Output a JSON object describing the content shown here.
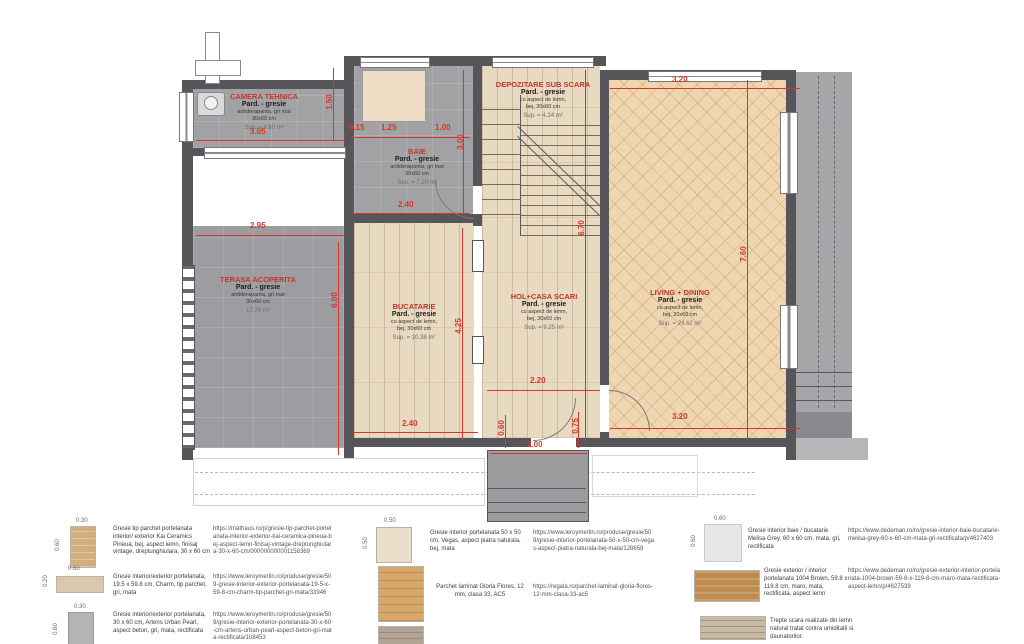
{
  "colors": {
    "dimension_red": "#d6372b",
    "room_title_red": "#c3352b",
    "wall_grey": "#56565a",
    "floor_grey": "#a2a2a5",
    "floor_wood": "#e8d9c1",
    "floor_herringbone": "#eed6b1"
  },
  "plan": {
    "rooms": [
      {
        "title": "CAMERA TEHNICA",
        "floor": "Pard. - gresie",
        "material": "antiderapanta, gri mat",
        "size": "30x60 cm",
        "area": "Sup. = 4.80 m²"
      },
      {
        "title": "BAIE",
        "floor": "Pard. - gresie",
        "material": "antiderapanta, gri mat",
        "size": "30x60 cm",
        "area": "Sup. = 7.20 m²"
      },
      {
        "title": "DEPOZITARE SUB SCARA",
        "floor": "Pard. - gresie",
        "material": "cu aspect de lemn,",
        "size": "bej, 30x60 cm",
        "area": "Sup. = 4.24 m²"
      },
      {
        "title": "TERASA ACOPERITA",
        "floor": "Pard. - gresie",
        "material": "antiderapanta, gri mat",
        "size": "30x60 cm",
        "area": "17.76 m²"
      },
      {
        "title": "BUCATARIE",
        "floor": "Pard. - gresie",
        "material": "cu aspect de lemn,",
        "size": "bej, 30x60 cm",
        "area": "Sup. = 10.38 m²"
      },
      {
        "title": "HOL+CASA SCARI",
        "floor": "Pard. - gresie",
        "material": "cu aspect de lemn,",
        "size": "bej, 30x60 cm",
        "area": "Sup. = 9.25 m²"
      },
      {
        "title": "LIVING + DINING",
        "floor": "Pard. - gresie",
        "material": "cu aspect de lemn,",
        "size": "bej, 20x60 cm",
        "area": "Sup. = 24.62 m²"
      }
    ],
    "dims": {
      "camera_w": "3.05",
      "camera_h": "1.50",
      "baie_seg1": "0.15",
      "baie_seg2": "1.25",
      "baie_seg3": "1.00",
      "baie_h": "3.00",
      "baie_w": "2.40",
      "terasa_w": "2.95",
      "terasa_h": "6.00",
      "bucatarie_h": "4.25",
      "hol_h": "6.70",
      "living_w_top": "3.20",
      "living_h": "7.60",
      "hol_w": "2.20",
      "bucatarie_w": "2.40",
      "entry_left": "0.60",
      "entry_w": "2.00",
      "entry_right": "0.75",
      "living_w_bottom": "3.20"
    }
  },
  "legend": {
    "items": [
      {
        "w": "0.30",
        "h": "0.60",
        "desc": "Gresie tip parchet portelanata interior/ exterior Kai Ceramics Pineua, bej, aspect lemn, finisaj vintage, dreptunghiulara, 30 x 60 cm",
        "url": "https://mathaus.ro/p/gresie-tip-parchet-portelanata-interior-exterior-kai-ceramica-pineua-bej-aspect-lemn-finisaj-vintage-dreptunghiulara-30-x-60-cm/000000000001158369"
      },
      {
        "w": "0.60",
        "h": "0.20",
        "desc": "Gresie interior/exterior portelanata, 19.5 x 59.8 cm, Charm, tip parchet, gri, mata",
        "url": "https://www.leroymerlin.ro/produse/gresie/509-gresie-interior-exterior-portelanata-19-5-x-59-8-cm-charm-tip-parchet-gri-mata/33946"
      },
      {
        "w": "0.30",
        "h": "0.60",
        "desc": "Gresie interior/exterior portelanata, 30 x 60 cm, Artens Urban Pearl, aspect beton, gri, mata, rectificata",
        "url": "https://www.leroymerlin.ro/produse/gresie/509/gresie-interior-exterior-portelanata-30-x-60-cm-artens-urban-pearl-aspect-beton-gri-mata-rectificata/108453"
      },
      {
        "w": "0.50",
        "h": "0.50",
        "desc": "Gresie interior portelanata 50 x 50 cm, Vegas, aspect piatra naturala, bej, mata",
        "url": "https://www.leroymerlin.ro/produse/gresie/509/gresie-interior-portelanata-50-x-50-cm-vegas-aspect-piatra-naturala-bej-mata/128659"
      },
      {
        "desc": "Parchet laminat Gloria Flores, 12 mm, clasa 33, AC5",
        "url": "https://regala.ro/parchet-laminat-gloria-flores-12-mm-clasa-33-ac5"
      },
      {
        "desc": "",
        "url": ""
      },
      {
        "w": "0.60",
        "h": "0.60",
        "desc": "Gresie interior baie / bucatarie Melisa Grey, 60 x 60 cm, mata, gri, rectificata",
        "url": "https://www.dedeman.ro/ro/gresie-interior-baie-bucatarie-melisa-grey-60-x-60-cm-mata-gri-rectificata/p/4627403"
      },
      {
        "desc": "Gresie exterior / interior portelanata 1004 Brown, 59.8 x 119.8 cm, maro, mata, rectificata, aspect lemn",
        "url": "https://www.dedeman.ro/ro/gresie-exterior-interior-portelanata-1004-brown-59-8-x-119-8-cm-maro-mata-rectificata-aspect-lemn/p/4627539"
      },
      {
        "desc": "Trepte scara realizate din lemn natural tratat contra umiditatii si daunatorilor.",
        "url": ""
      }
    ]
  }
}
